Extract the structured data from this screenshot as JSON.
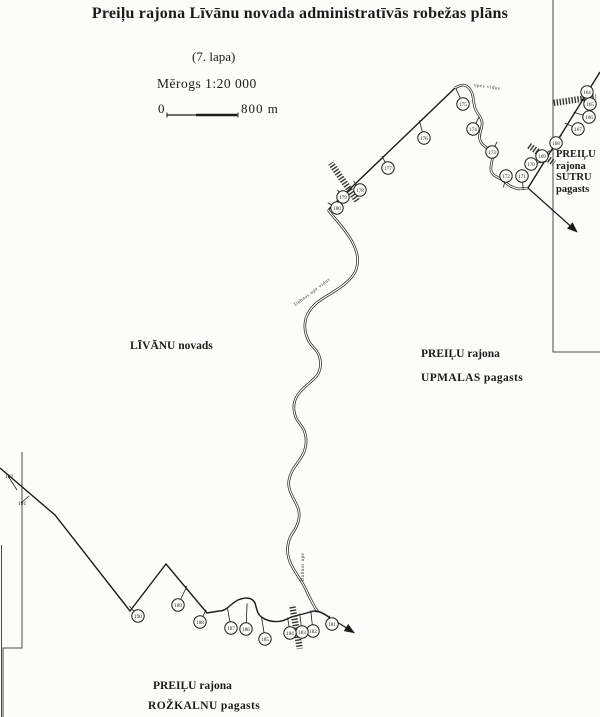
{
  "header": {
    "title": "Preiļu rajona Līvānu novada administratīvās robežas plāns",
    "sheet": "(7. lapa)",
    "scale_label": "Mērogs 1:20  000",
    "scalebar": {
      "start": "0",
      "end": "800  m"
    }
  },
  "regions": {
    "livanu": "LĪVĀNU novads",
    "upmalas_lines": [
      "PREIĻU rajona",
      "UPMALAS  pagasts"
    ],
    "sutru_lines": [
      "PREIĻU",
      "rajona",
      "SUTRU",
      "pagasts"
    ],
    "rozkalnu_lines": [
      "PREIĻU rajona",
      "ROŽKALNU  pagasts"
    ]
  },
  "river_labels": [
    {
      "text": "Dubnas upe vidus",
      "x": 313,
      "y": 293,
      "rotate": -37
    },
    {
      "text": "Dubnas upe",
      "x": 304,
      "y": 567,
      "rotate": -90
    },
    {
      "text": "upes vidus",
      "x": 487,
      "y": 88,
      "rotate": 8
    }
  ],
  "boundary_points": [
    {
      "n": "164",
      "x": 587,
      "y": 92,
      "ax": 584,
      "ay": 96
    },
    {
      "n": "165",
      "x": 590,
      "y": 104,
      "ax": 583,
      "ay": 100
    },
    {
      "n": "166",
      "x": 589,
      "y": 117,
      "ax": 576,
      "ay": 113
    },
    {
      "n": "167",
      "x": 578,
      "y": 129,
      "ax": 567,
      "ay": 124
    },
    {
      "n": "168",
      "x": 556,
      "y": 143,
      "ax": 560,
      "ay": 137
    },
    {
      "n": "169",
      "x": 542,
      "y": 156,
      "ax": 548,
      "ay": 152
    },
    {
      "n": "170",
      "x": 531,
      "y": 164,
      "ax": 544,
      "ay": 162
    },
    {
      "n": "171",
      "x": 522,
      "y": 176,
      "ax": 523,
      "ay": 187
    },
    {
      "n": "172",
      "x": 506,
      "y": 176,
      "ax": 504,
      "ay": 185
    },
    {
      "n": "173",
      "x": 492,
      "y": 152,
      "ax": 496,
      "ay": 144
    },
    {
      "n": "174",
      "x": 473,
      "y": 129,
      "ax": 478,
      "ay": 119
    },
    {
      "n": "175",
      "x": 463,
      "y": 104,
      "ax": 457,
      "ay": 91
    },
    {
      "n": "176",
      "x": 424,
      "y": 138,
      "ax": 420,
      "ay": 123
    },
    {
      "n": "177",
      "x": 388,
      "y": 168,
      "ax": 383,
      "ay": 158
    },
    {
      "n": "178",
      "x": 360,
      "y": 190,
      "ax": 355,
      "ay": 183
    },
    {
      "n": "179",
      "x": 343,
      "y": 197,
      "ax": 339,
      "ay": 192
    },
    {
      "n": "180",
      "x": 337,
      "y": 208,
      "ax": 330,
      "ay": 204
    },
    {
      "n": "181",
      "x": 332,
      "y": 624,
      "ax": 330,
      "ay": 618
    },
    {
      "n": "182",
      "x": 313,
      "y": 631,
      "ax": 311,
      "ay": 613
    },
    {
      "n": "183",
      "x": 302,
      "y": 632,
      "ax": 300,
      "ay": 616
    },
    {
      "n": "184",
      "x": 290,
      "y": 633,
      "ax": 288,
      "ay": 620
    },
    {
      "n": "185",
      "x": 265,
      "y": 639,
      "ax": 262,
      "ay": 620
    },
    {
      "n": "186",
      "x": 246,
      "y": 629,
      "ax": 247,
      "ay": 606
    },
    {
      "n": "187",
      "x": 231,
      "y": 628,
      "ax": 228,
      "ay": 611
    },
    {
      "n": "188",
      "x": 200,
      "y": 622,
      "ax": 205,
      "ay": 612
    },
    {
      "n": "189",
      "x": 178,
      "y": 605,
      "ax": 186,
      "ay": 588
    },
    {
      "n": "190",
      "x": 138,
      "y": 616,
      "ax": 131,
      "ay": 608
    }
  ],
  "edge_labels": [
    {
      "n": "192",
      "x": 5,
      "y": 478,
      "ax": 17,
      "ay": 490
    },
    {
      "n": "191",
      "x": 18,
      "y": 505,
      "ax": 29,
      "ay": 496
    }
  ]
}
